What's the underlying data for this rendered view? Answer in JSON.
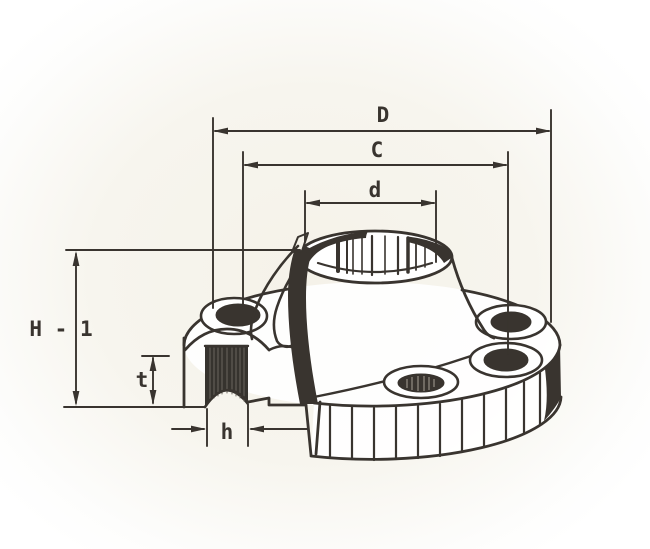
{
  "diagram": {
    "type": "weld-neck-flange-cutaway-section",
    "ink_color": "#39342f",
    "paper_color": "#f5f2e9",
    "dimension_labels": {
      "outer_diameter": "D",
      "bolt_circle_diameter": "C",
      "neck_diameter": "d",
      "overall_height": "H - 1",
      "flange_thickness": "t",
      "bolt_hole_diameter": "h"
    }
  }
}
